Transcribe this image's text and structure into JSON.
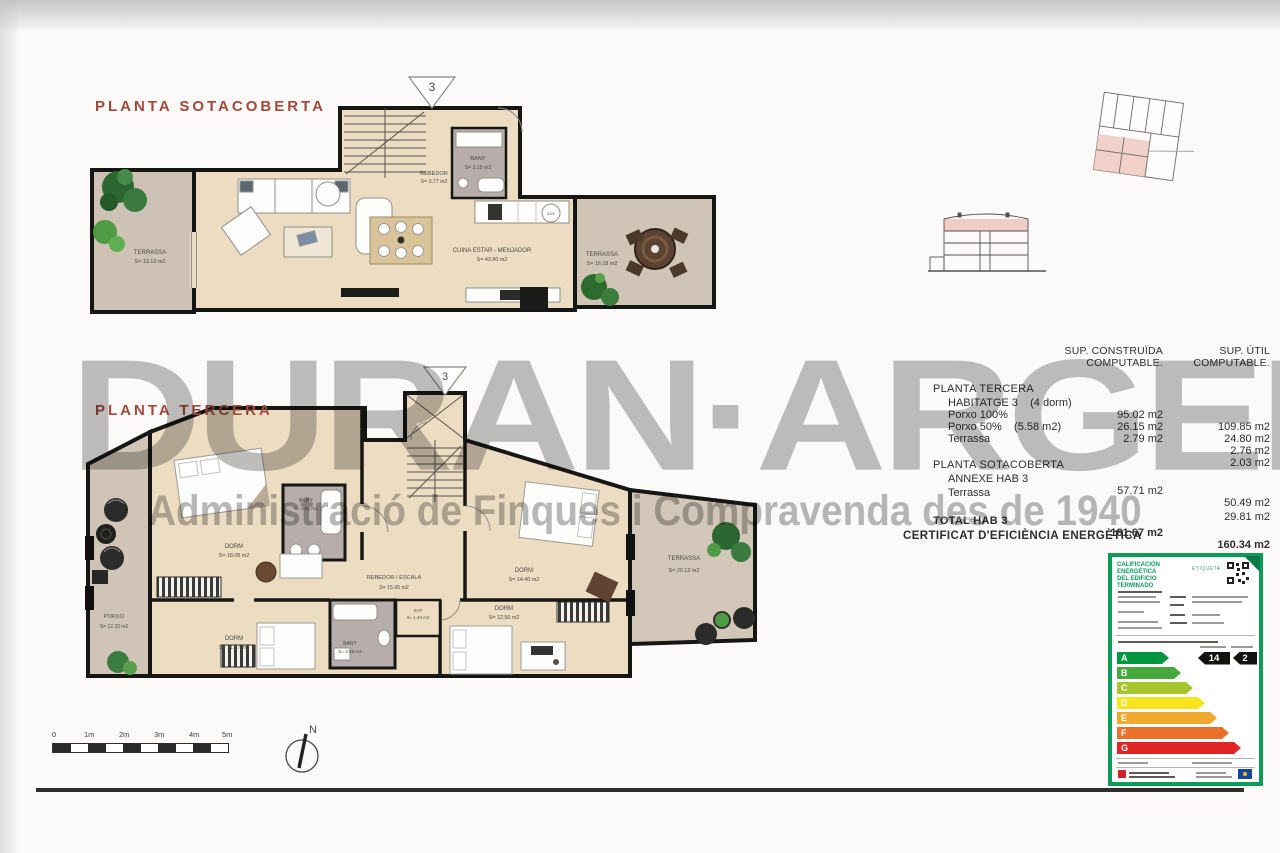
{
  "page": {
    "titles": {
      "plan_top": "PLANTA SOTACOBERTA",
      "plan_bottom": "PLANTA TERCERA"
    },
    "watermark": {
      "line1": "DURAN·ARGEMÍ",
      "line2": "Administració de Finques i Compravenda des de 1940"
    },
    "marker_number": "3"
  },
  "plan_sotacoberta": {
    "rooms": [
      {
        "name": "TERRASSA",
        "area": "S= 13.13 m2"
      },
      {
        "name": "REBEDOR",
        "area": "S= 3.77 m2"
      },
      {
        "name": "BANY",
        "area": "S= 3.19 m2"
      },
      {
        "name": "CUINA ESTAR - MENJADOR",
        "area": "S= 43.80 m2"
      },
      {
        "name": "TERRASSA",
        "area": "S= 16.18 m2"
      }
    ],
    "labels": {
      "acs": "ACS"
    }
  },
  "plan_tercera": {
    "rooms": [
      {
        "name": "DORM",
        "area": "S= 18.05 m2"
      },
      {
        "name": "BANY",
        "area": "S= 4.82 m2"
      },
      {
        "name": "REBEDOR I ESCALA",
        "area": "S= 15.65 m2"
      },
      {
        "name": "SAT",
        "area": "S= 1.44 m2"
      },
      {
        "name": "BANY",
        "area": "S= 3.95 m2"
      },
      {
        "name": "DORM",
        "area": "S= 11.67 m2"
      },
      {
        "name": "DORM",
        "area": "S= 14.40 m2"
      },
      {
        "name": "DORM",
        "area": "S= 12.50 m2"
      },
      {
        "name": "PORXO",
        "area": "S= 12.23 m2"
      },
      {
        "name": "TERRASSA",
        "area": "S= 20.12 m2"
      }
    ]
  },
  "areas_table": {
    "col1_header_line1": "SUP. CONSTRUÏDA",
    "col1_header_line2": "COMPUTABLE.",
    "col2_header_line1": "SUP. ÚTIL",
    "col2_header_line2": "COMPUTABLE.",
    "sections": [
      {
        "title": "PLANTA TERCERA",
        "rows": [
          {
            "label": "HABITATGE 3    (4 dorm)",
            "built": "95.02 m2",
            "useful": "109.85 m2"
          },
          {
            "label": "Porxo 100%",
            "built": "26.15 m2",
            "useful": "24.80 m2"
          },
          {
            "label": "Porxo 50%    (5.58 m2)",
            "built": "2.79 m2",
            "useful": "2.76 m2"
          },
          {
            "label": "Terrassa",
            "built": "",
            "useful": "2.03 m2"
          }
        ]
      },
      {
        "title": "PLANTA SOTACOBERTA",
        "rows": [
          {
            "label": "ANNEXE HAB 3",
            "built": "57.71 m2",
            "useful": "50.49 m2"
          },
          {
            "label": "Terrassa",
            "built": "",
            "useful": "29.81 m2"
          }
        ]
      }
    ],
    "total": {
      "label": "TOTAL HAB 3",
      "note": "*Sense Terrassa",
      "built": "181.67 m2",
      "useful": "160.34 m2"
    },
    "certificate_title": "CERTIFICAT D'EFICIÈNCIA ENERGÈTICA"
  },
  "energy_label": {
    "title_line1": "CALIFICACIÓN ENERGÉTICA",
    "title_line2": "DEL EDIFICIO TERMINADO",
    "tag": "ETIQUETA",
    "ratings": [
      {
        "letter": "A",
        "color": "#009640"
      },
      {
        "letter": "B",
        "color": "#45a93c"
      },
      {
        "letter": "C",
        "color": "#a6c52e"
      },
      {
        "letter": "D",
        "color": "#f8e31c"
      },
      {
        "letter": "E",
        "color": "#f0a92e"
      },
      {
        "letter": "F",
        "color": "#ea702c"
      },
      {
        "letter": "G",
        "color": "#df2623"
      }
    ],
    "values": {
      "consumption": "14",
      "emissions": "2"
    }
  },
  "scale_bar": {
    "ticks": [
      "0",
      "1m",
      "2m",
      "3m",
      "4m",
      "5m"
    ]
  },
  "north": {
    "label": "N"
  }
}
